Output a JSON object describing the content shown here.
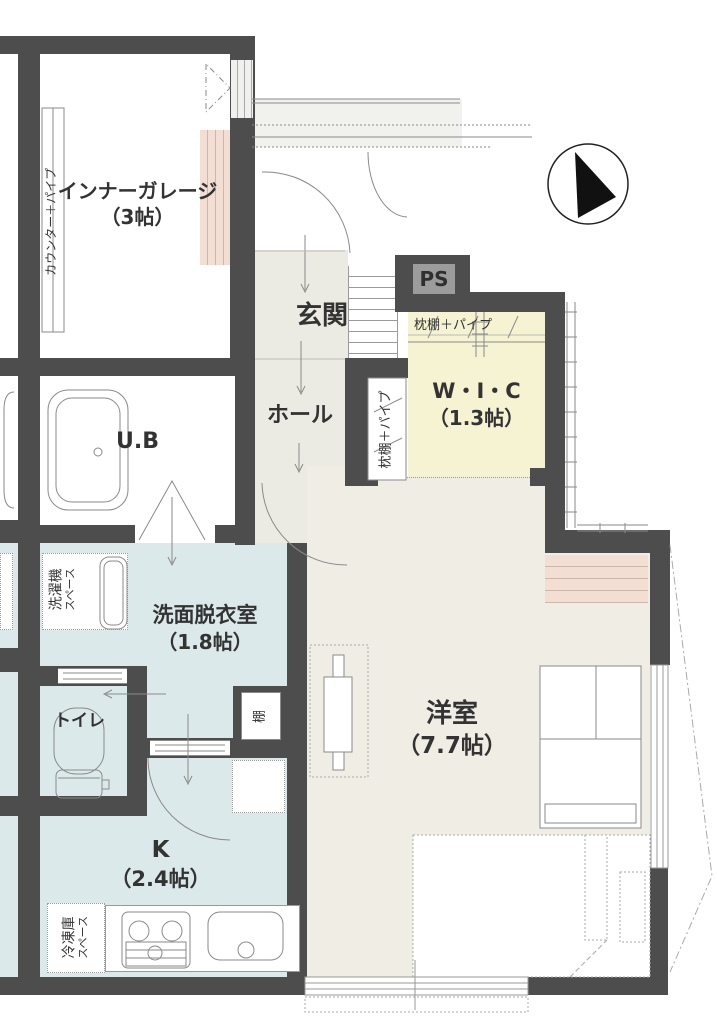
{
  "colors": {
    "wall": "#4d4d4d",
    "wet_room": "#dbe9ea",
    "western_room": "#f0ede5",
    "hall": "#ecebe3",
    "wic": "#f6f3d3",
    "accent_pink": "#f3ded4",
    "ps_background": "#9c9c9c"
  },
  "rooms": {
    "inner_garage": {
      "name": "インナーガレージ",
      "size": "（3帖）"
    },
    "entrance": {
      "name": "玄関"
    },
    "hall": {
      "name": "ホール"
    },
    "walk_in_closet": {
      "name": "W・I・C",
      "size": "（1.3帖）"
    },
    "unit_bath": {
      "name": "U.B"
    },
    "washroom": {
      "name": "洗面脱衣室",
      "size": "（1.8帖）"
    },
    "toilet": {
      "name": "トイレ"
    },
    "kitchen": {
      "name": "K",
      "size": "（2.4帖）"
    },
    "western_room": {
      "name": "洋室",
      "size": "（7.7帖）"
    }
  },
  "labels": {
    "counter_pipe": "カウンター＋パイプ",
    "pillow_shelf_pipe_top": "枕棚＋パイプ",
    "pillow_shelf_pipe_side": "枕棚＋パイプ",
    "pipe_space": "PS",
    "shelf": "棚",
    "washer_space_line1": "洗濯機",
    "washer_space_line2": "スペース",
    "freezer_space_line1": "冷凍庫",
    "freezer_space_line2": "スペース"
  },
  "compass": {
    "meaning": "north-arrow"
  }
}
